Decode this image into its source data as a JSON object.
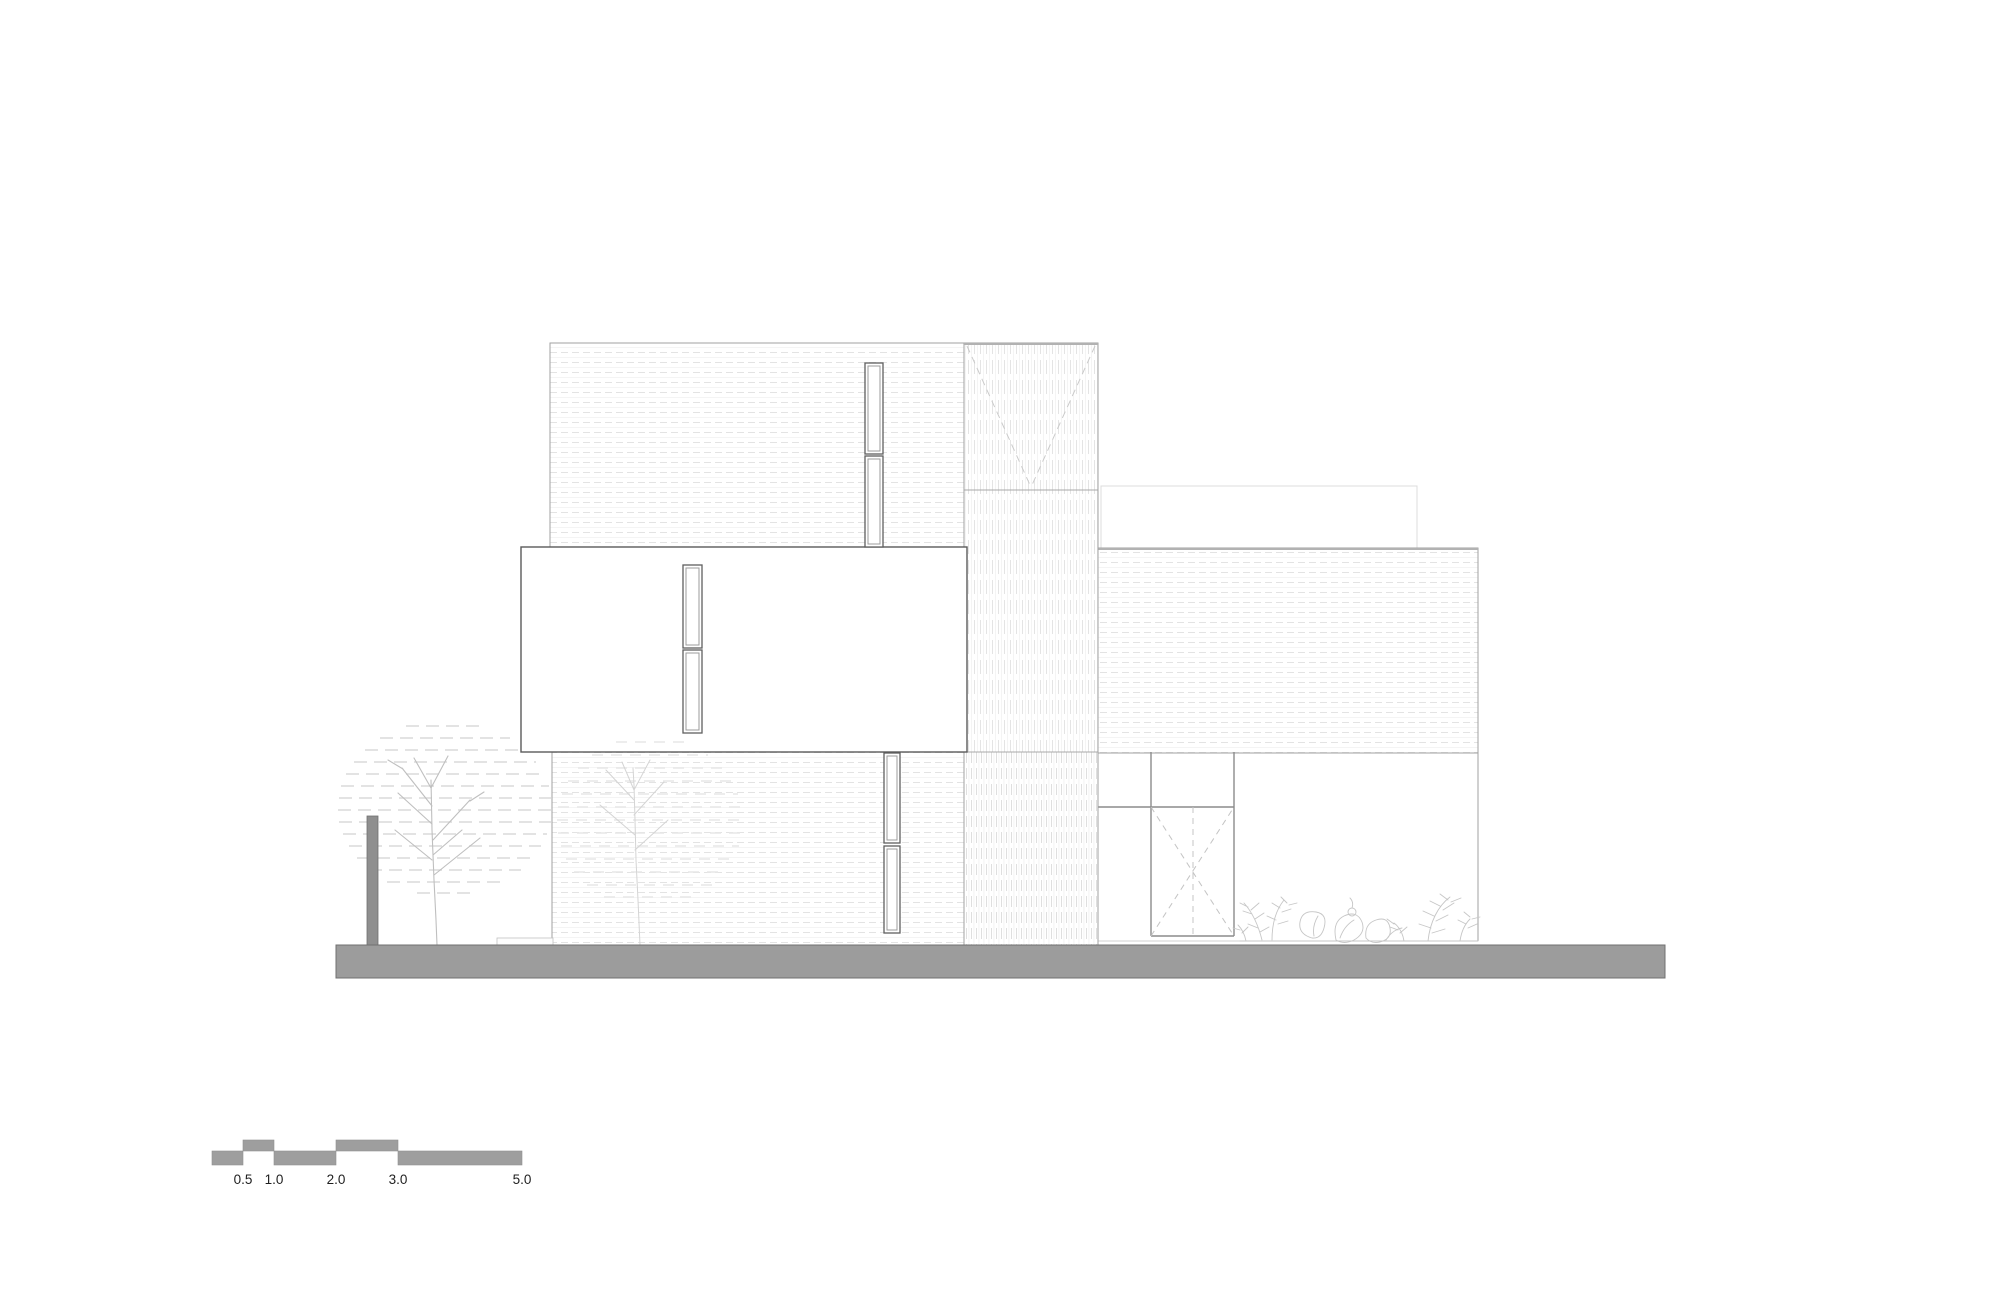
{
  "figure": {
    "kind": "architectural-elevation-drawing",
    "elevation": {
      "volumes": [
        {
          "name": "upper-left-block",
          "hatch": "horizontal-dashed",
          "windows": 2
        },
        {
          "name": "cantilevered-white-box",
          "hatch": "none",
          "windows": 2
        },
        {
          "name": "lower-left-block",
          "hatch": "horizontal-dashed",
          "windows": 2
        },
        {
          "name": "central-tower",
          "hatch": "vertical-slats",
          "marking": "chevron-v"
        },
        {
          "name": "right-block",
          "hatch": "horizontal-dashed"
        },
        {
          "name": "right-ground-floor",
          "hatch": "none",
          "marking": "dashed-door-x"
        },
        {
          "name": "roof-parapet-outline",
          "hatch": "none"
        }
      ],
      "site": [
        "ground-slab",
        "light-pole",
        "large-tree",
        "small-tree",
        "shrub-planting",
        "plinth-step"
      ]
    }
  },
  "scale_bar": {
    "labels": [
      "0.5",
      "1.0",
      "2.0",
      "3.0",
      "5.0"
    ]
  },
  "palette": {
    "background": "#ffffff",
    "ground_gray": "#9c9c9c",
    "pole_gray": "#8f8f8f",
    "scale_bar_gray": "#9e9e9e",
    "block_outline": "#a2a2a2",
    "box_outline": "#5a5a5a",
    "window_frame": "#5f5f5f",
    "opening_frame": "#8c8c8c",
    "hatch_line": "#e3e3e3",
    "faint_outline": "#dcdcdc",
    "dashed_marking": "#cbcbcb",
    "vegetation_line": "#c6c6c6",
    "label_text": "#1f1f1f"
  }
}
